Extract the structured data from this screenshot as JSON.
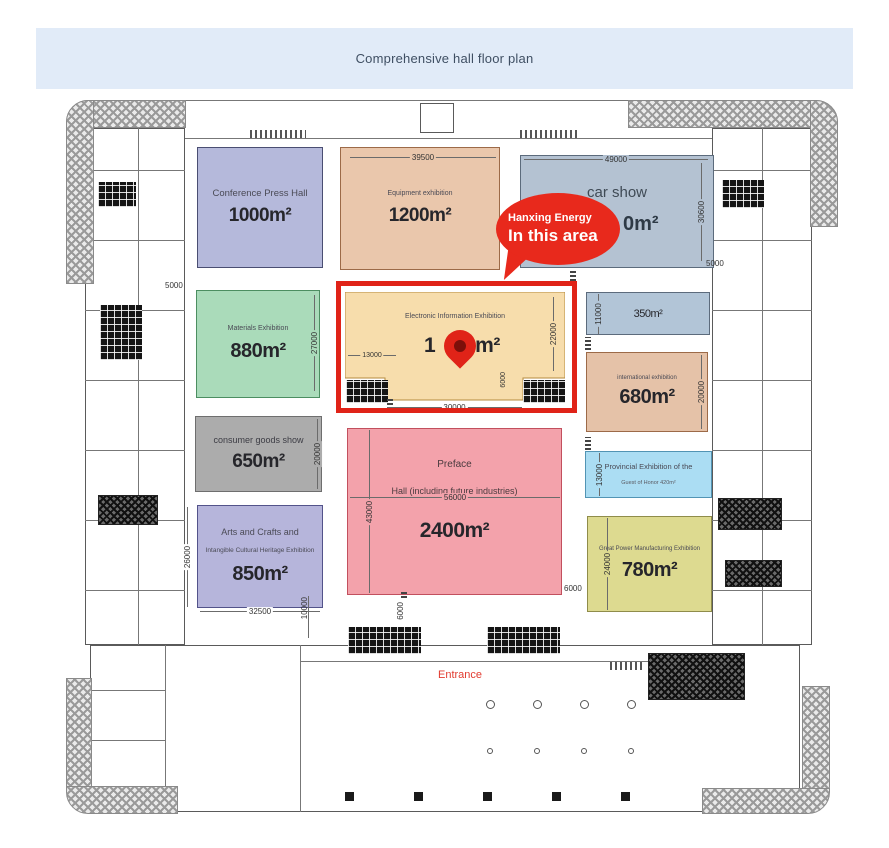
{
  "header": {
    "title": "Comprehensive hall floor plan"
  },
  "callout": {
    "title": "Hanxing Energy",
    "subtitle": "In this area"
  },
  "map": {
    "entrance_label": "Entrance"
  },
  "colors": {
    "header_bg": "#e1ebf8",
    "highlight_red": "#e02318",
    "bubble_red": "#e8291c",
    "entrance_text": "#e23b30"
  },
  "zones": {
    "conference": {
      "name": "Conference Press Hall",
      "area": "1000m²",
      "color": "#b5b9db"
    },
    "equipment": {
      "name": "Equipment exhibition",
      "area": "1200m²",
      "color": "#eac7ac",
      "width_dim": "39500"
    },
    "car_show": {
      "name": "car show",
      "area_visible_fragment": "0m²",
      "color": "#b4c2d2",
      "width_dim": "49000",
      "height_dim": "30600",
      "right_dim": "5000"
    },
    "materials": {
      "name": "Materials Exhibition",
      "area": "880m²",
      "color": "#aadbba",
      "height_dim": "27000",
      "left_dim": "5000"
    },
    "electronic": {
      "name": "Electronic Information Exhibition",
      "area_fragment_left": "1",
      "area_fragment_right": "0m²",
      "color": "#f7ddac",
      "width_dim_left": "13000",
      "height_dim": "22000",
      "bottom_dim": "30000",
      "notch_dim": "6000"
    },
    "hall_350": {
      "area": "350m²",
      "color": "#b2c5d7",
      "height_dim": "11000"
    },
    "international": {
      "name": "international exhibition",
      "area": "680m²",
      "color": "#e5c2a8",
      "height_dim": "20000"
    },
    "consumer": {
      "name": "consumer goods show",
      "area": "650m²",
      "color": "#acacac",
      "height_dim": "20000"
    },
    "preface": {
      "name_line1": "Preface",
      "name_line2": "Hall (including future industries)",
      "area": "2400m²",
      "color": "#f3a2ab",
      "width_dim": "56000",
      "height_dim": "43000",
      "bottom_dim": "6000",
      "right_dim": "6000"
    },
    "provincial": {
      "name": "Provincial Exhibition of the",
      "subtitle": "Guest of Honor 420m²",
      "color": "#abddf3",
      "height_dim": "13000"
    },
    "arts": {
      "name_line1": "Arts and Crafts and",
      "name_line2": "Intangible Cultural Heritage Exhibition",
      "area": "850m²",
      "color": "#b6b5db",
      "height_dim": "26000",
      "width_dim": "32500"
    },
    "power": {
      "name": "Great Power Manufacturing Exhibition",
      "area": "780m²",
      "color": "#ddda90",
      "height_dim": "24000"
    }
  },
  "dimensions": {
    "bottom_left": "10000"
  }
}
